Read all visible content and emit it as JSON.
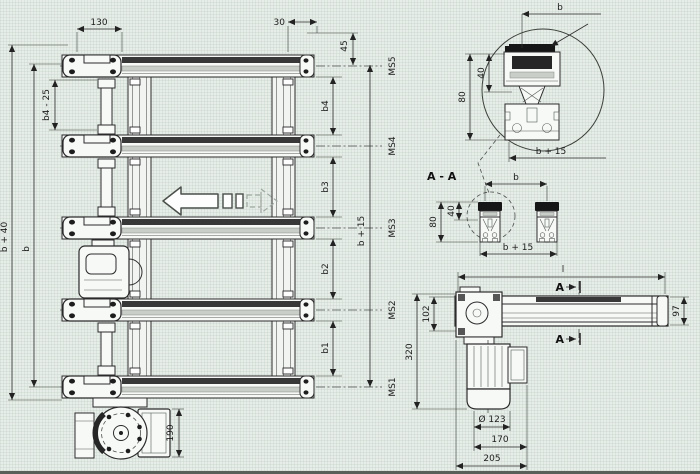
{
  "colors": {
    "background": "#e7ede8",
    "line": "#2b2b2b",
    "belt": "#383838"
  },
  "plan": {
    "dim_130": "130",
    "dim_30": "30",
    "dim_45": "45",
    "dim_b4_25": "b4 - 25",
    "dim_b40": "b + 40",
    "dim_b": "b",
    "gap_dims": [
      "b4",
      "b3",
      "b2",
      "b1"
    ],
    "dim_b15": "b + 15",
    "ms_labels": [
      "MS5",
      "MS4",
      "MS3",
      "MS2",
      "MS1"
    ],
    "dim_190": "190"
  },
  "detail": {
    "dim_b": "b",
    "dim_40": "40",
    "dim_80": "80",
    "dim_b15": "b + 15"
  },
  "section": {
    "title": "A - A",
    "dim_b": "b",
    "dim_40": "40",
    "dim_80": "80",
    "dim_b15": "b + 15"
  },
  "side": {
    "dim_l": "l",
    "marker_a_top": "A",
    "marker_a_bottom": "A",
    "dim_102": "102",
    "dim_320": "320",
    "dim_97": "97",
    "dim_dia": "Ø 123",
    "dim_170": "170",
    "dim_205": "205"
  }
}
